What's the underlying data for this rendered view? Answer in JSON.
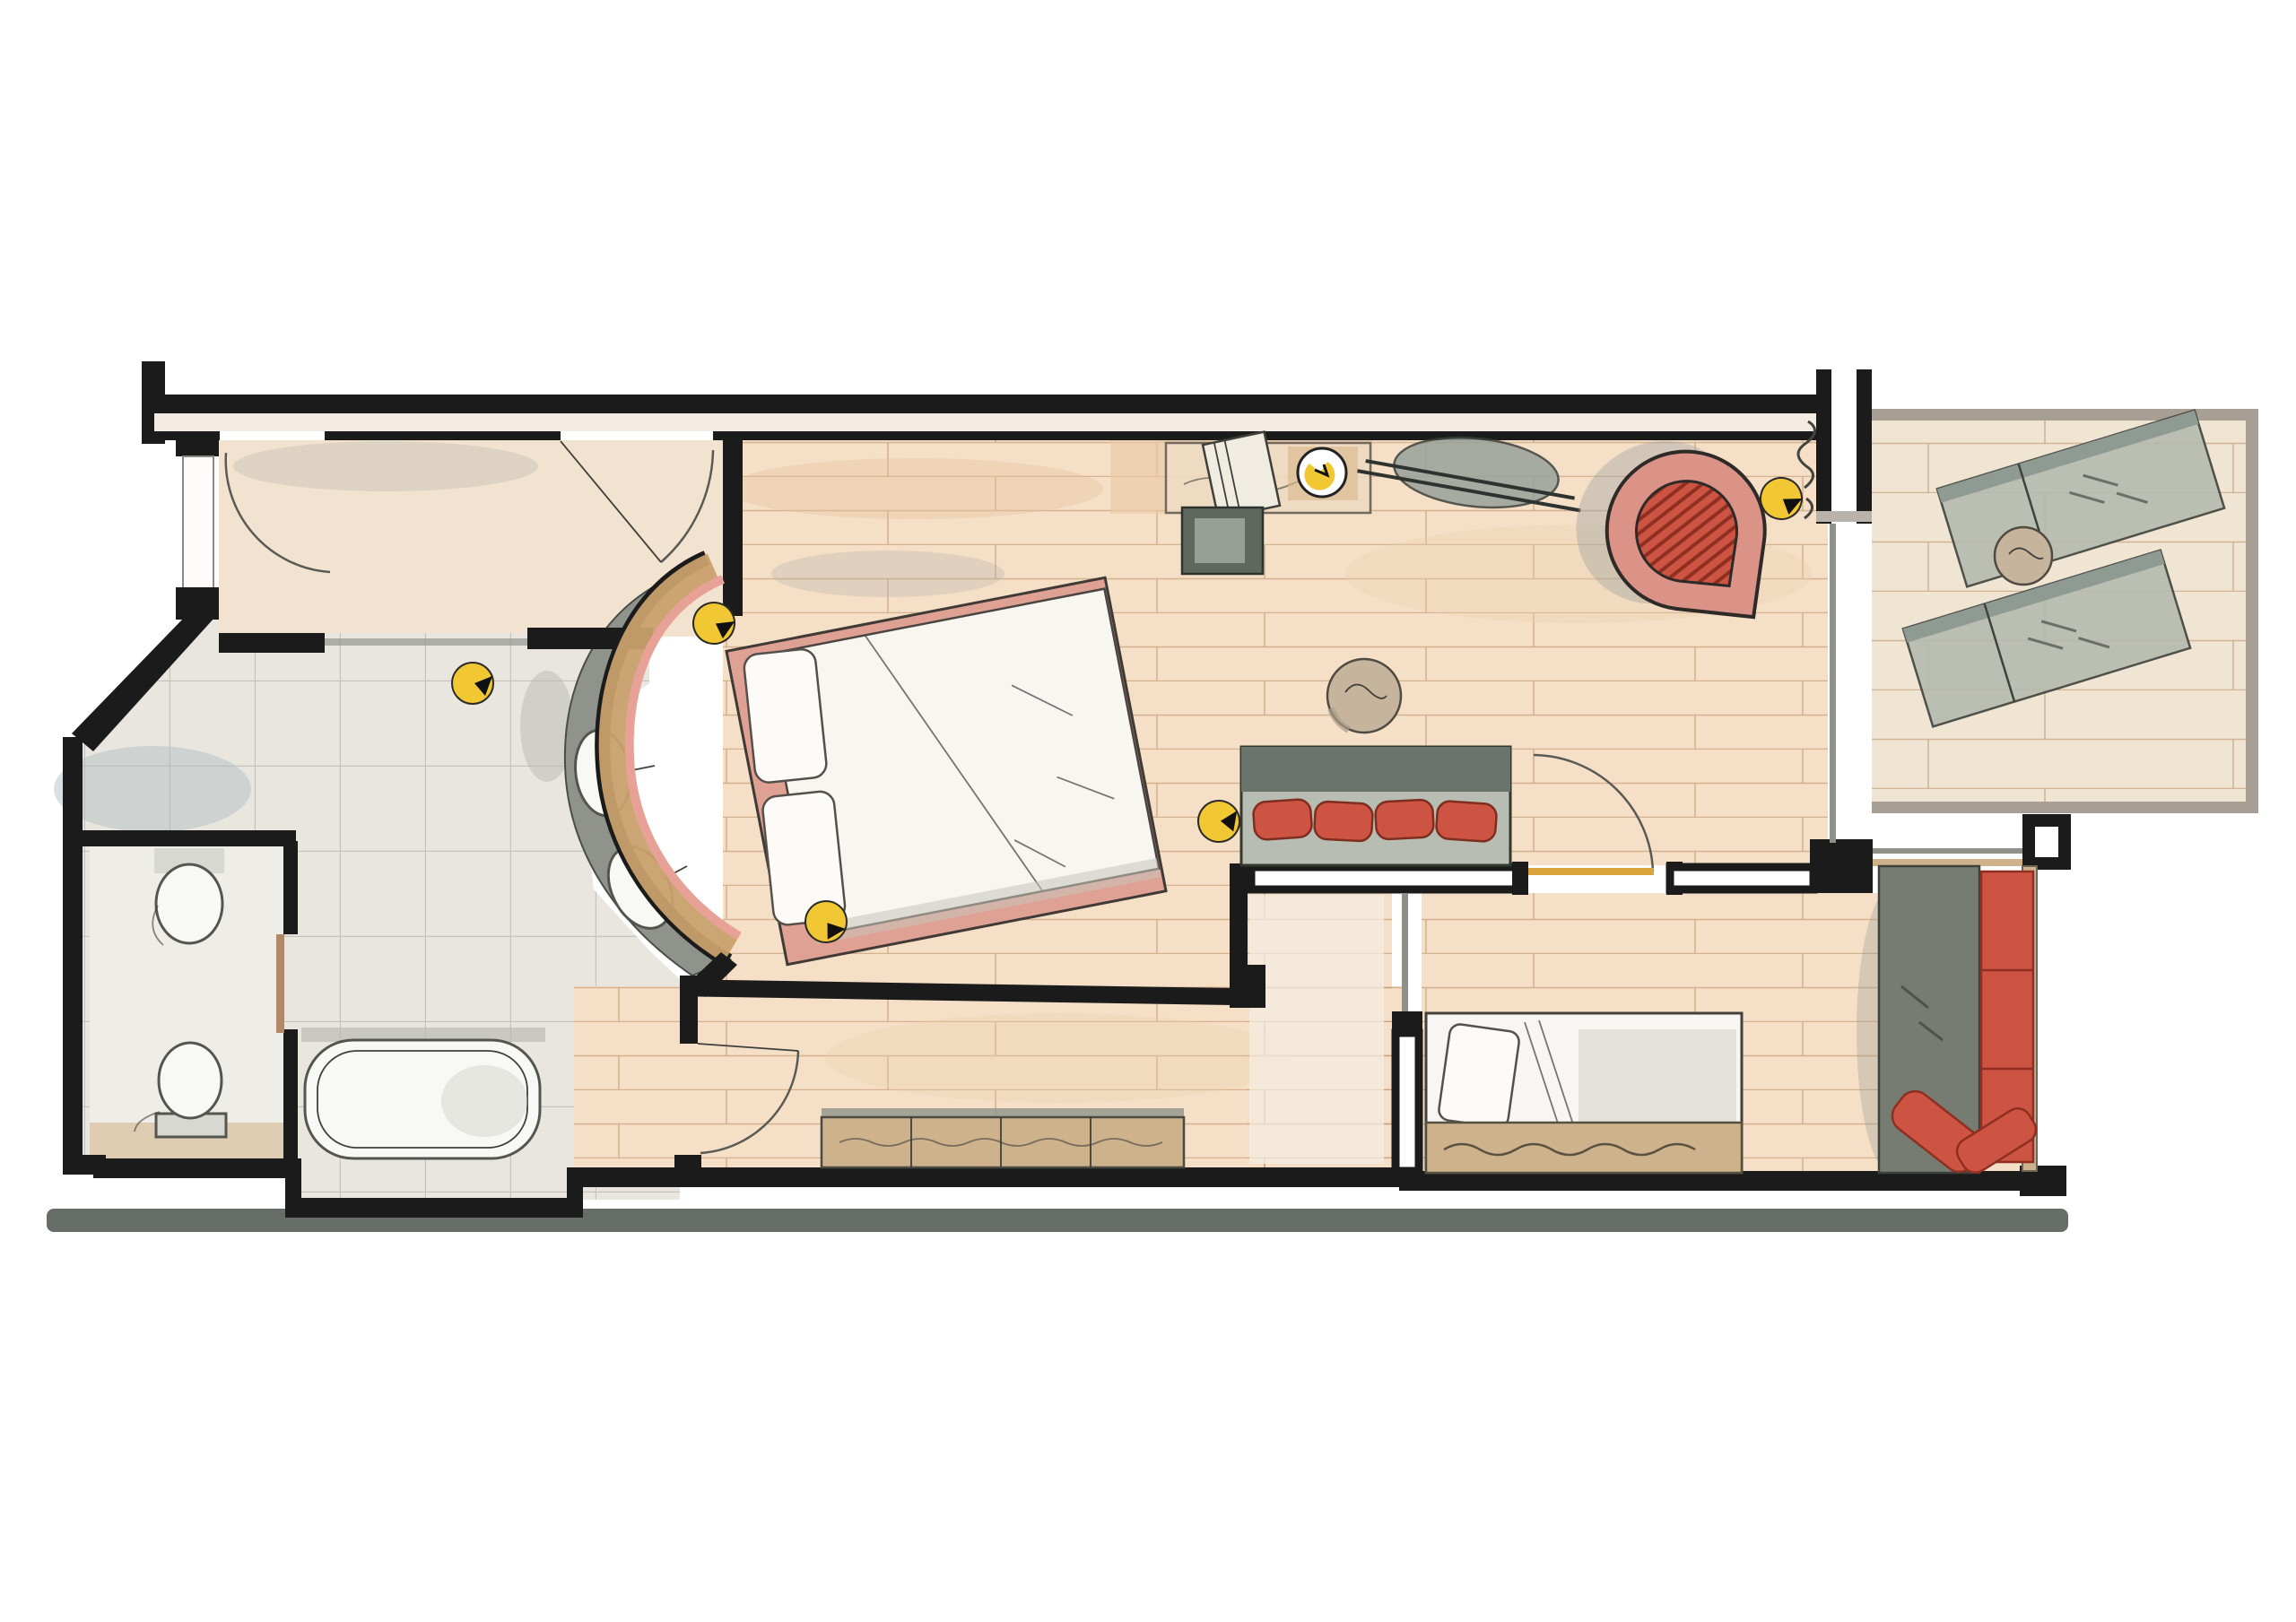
{
  "meta": {
    "title": "Watercolor floor plan sketch of a hotel family suite",
    "style": "hand-drawn ink and watercolor, top-down plan",
    "visible_text": "none"
  },
  "colors": {
    "wall": "#1b1b1b",
    "outline": "#3f3f3c",
    "wood": "#f5dfc6",
    "woodwash": "#e9c9a6",
    "plankline": "#b98d66",
    "balconywood": "#f0e4d2",
    "hall": "#f2e3d0",
    "tile": "#e9e6df",
    "tileline": "#8f8f8f",
    "counter": "#8f938b",
    "tan": "#cdb28c",
    "headboard": "#c8a06c",
    "pink": "#e8a196",
    "bedbase": "#dfa193",
    "red": "#cd5342",
    "reddeep": "#8e2f22",
    "sofaback": "#6a746c",
    "sofaseat": "#b8bdb3",
    "graybench": "#767c72",
    "yellow": "#f1c733",
    "ground": "#4c554d",
    "glass": "#8d9188",
    "fixture": "#f8f8f5",
    "wash": "#c9c5bd",
    "doorleaf": "#b08968",
    "doorleafyellow": "#d9a43c"
  },
  "rooms": [
    {
      "id": "entrance-hall",
      "name": "Entrance hall",
      "floor": "beige screed"
    },
    {
      "id": "shower-area",
      "name": "Shower area",
      "floor": "gray tile"
    },
    {
      "id": "wc-room",
      "name": "WC with toilet and bidet",
      "floor": "gray tile"
    },
    {
      "id": "bath-room",
      "name": "Bathroom with tub and curved twin vanity",
      "floor": "gray tile"
    },
    {
      "id": "bedroom-living",
      "name": "Bedroom / living room",
      "floor": "wood planks"
    },
    {
      "id": "corridor",
      "name": "Inner corridor with sideboard",
      "floor": "wood planks"
    },
    {
      "id": "children-room",
      "name": "Children's room",
      "floor": "wood planks"
    },
    {
      "id": "balcony",
      "name": "Balcony terrace",
      "floor": "light wood decking"
    }
  ],
  "furniture": [
    {
      "room": "bedroom-living",
      "items": [
        "double bed with two pillows",
        "curved upholstered headboard wall",
        "desk with chair and round yellow table lamp",
        "dark ottoman / luggage bench",
        "oval wall console with rail",
        "red egg lounge chair",
        "boulder side table",
        "gray sofa with four red cushions"
      ]
    },
    {
      "room": "bath-room",
      "items": [
        "bathtub",
        "curved vanity counter with two oval basins"
      ]
    },
    {
      "room": "wc-room",
      "items": [
        "toilet",
        "bidet"
      ]
    },
    {
      "room": "corridor",
      "items": [
        "long low sideboard"
      ]
    },
    {
      "room": "children-room",
      "items": [
        "single bed with pillow",
        "gray window bench",
        "red seat cushions",
        "two loose red pillows"
      ]
    },
    {
      "room": "balcony",
      "items": [
        "two sun loungers",
        "round bistro table"
      ]
    }
  ],
  "fixtures": {
    "ceiling_spotlights": 5,
    "table_lamps": 1,
    "door_swings_drawn": 6,
    "washbasins": 2,
    "toilets": 2,
    "sun_loungers": 2
  }
}
